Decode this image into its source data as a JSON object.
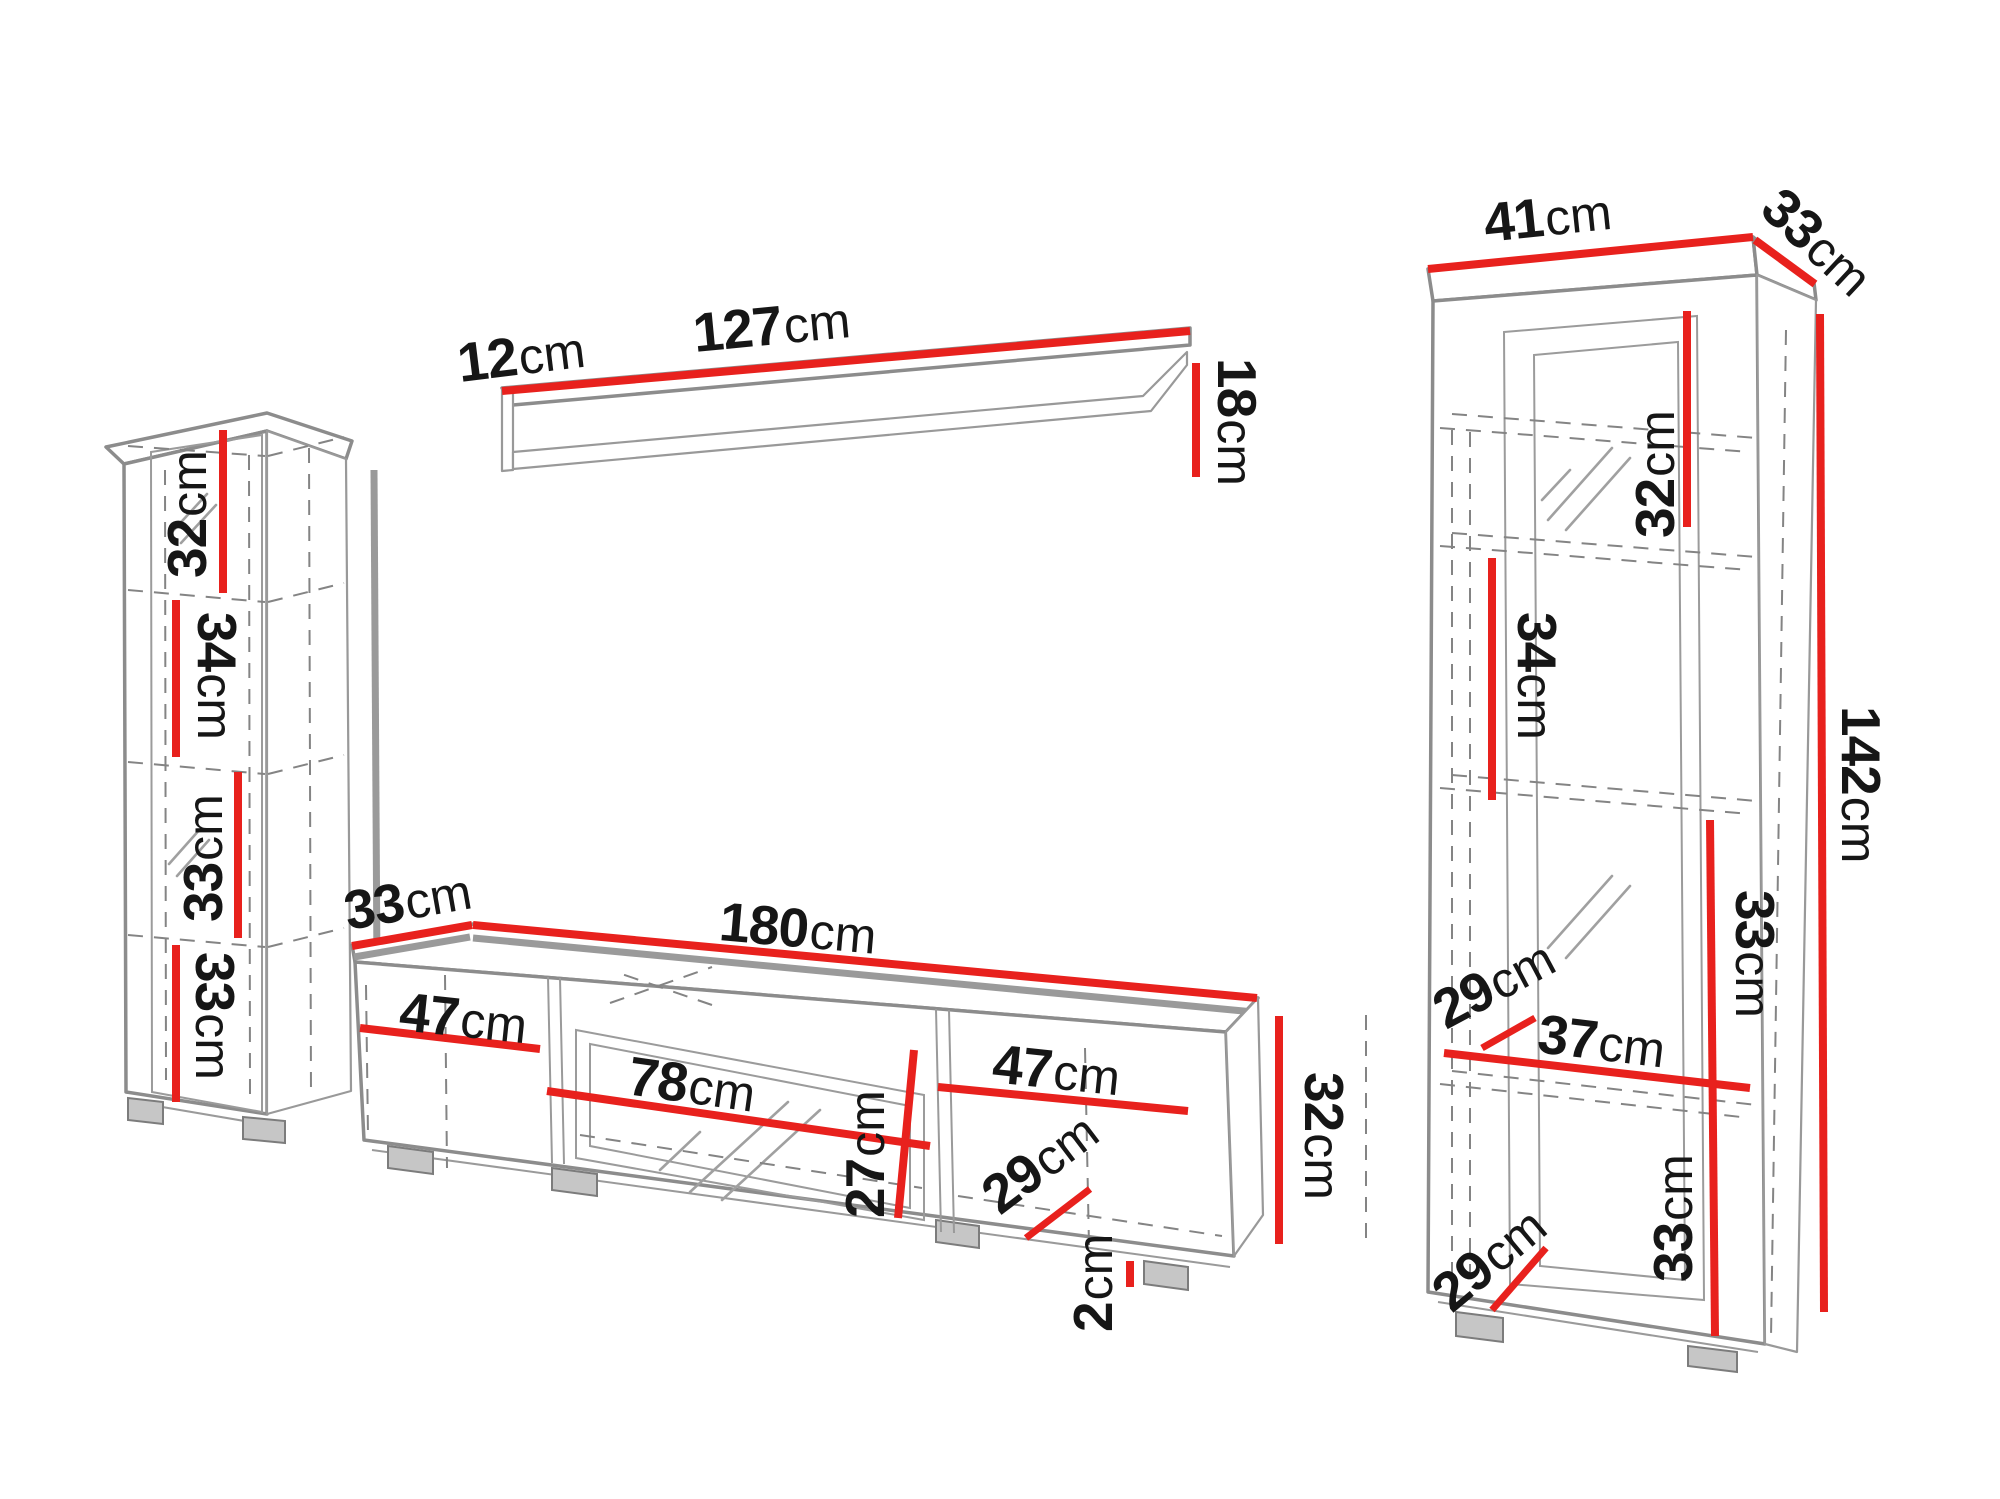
{
  "figure": {
    "kind": "furniture-wall-unit-dimension-diagram",
    "unit": "cm",
    "accent_color": "#e8211d",
    "outline_color": "#8c8c8c",
    "text_color": "#161616"
  },
  "left_cabinet": {
    "name": "left tall column cabinet",
    "dims": [
      {
        "num": "32",
        "unit": "cm"
      },
      {
        "num": "34",
        "unit": "cm"
      },
      {
        "num": "33",
        "unit": "cm"
      },
      {
        "num": "33",
        "unit": "cm"
      }
    ]
  },
  "wall_shelf": {
    "name": "wall shelf",
    "dims": [
      {
        "num": "12",
        "unit": "cm"
      },
      {
        "num": "127",
        "unit": "cm"
      },
      {
        "num": "18",
        "unit": "cm"
      }
    ]
  },
  "tv_stand": {
    "name": "tv stand",
    "dims": [
      {
        "num": "33",
        "unit": "cm"
      },
      {
        "num": "180",
        "unit": "cm"
      },
      {
        "num": "47",
        "unit": "cm"
      },
      {
        "num": "78",
        "unit": "cm"
      },
      {
        "num": "27",
        "unit": "cm"
      },
      {
        "num": "47",
        "unit": "cm"
      },
      {
        "num": "29",
        "unit": "cm"
      },
      {
        "num": "32",
        "unit": "cm"
      },
      {
        "num": "2",
        "unit": "cm"
      }
    ]
  },
  "right_cabinet": {
    "name": "right tall display cabinet",
    "dims": [
      {
        "num": "41",
        "unit": "cm"
      },
      {
        "num": "33",
        "unit": "cm"
      },
      {
        "num": "32",
        "unit": "cm"
      },
      {
        "num": "34",
        "unit": "cm"
      },
      {
        "num": "29",
        "unit": "cm"
      },
      {
        "num": "37",
        "unit": "cm"
      },
      {
        "num": "33",
        "unit": "cm"
      },
      {
        "num": "33",
        "unit": "cm"
      },
      {
        "num": "29",
        "unit": "cm"
      },
      {
        "num": "142",
        "unit": "cm"
      }
    ]
  }
}
